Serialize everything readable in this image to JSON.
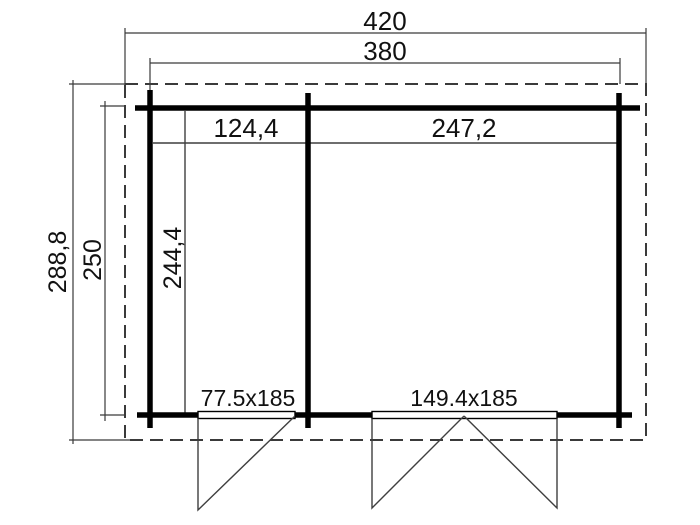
{
  "drawing": {
    "type": "floor-plan",
    "rooms": 2,
    "labels": {
      "overall_width": "420",
      "wall_outer_width": "380",
      "overall_depth": "288,8",
      "wall_outer_depth": "250",
      "left_room_width": "124,4",
      "right_room_width": "247,2",
      "interior_depth": "244,4",
      "single_door_size": "77.5x185",
      "double_door_size": "149.4x185"
    }
  },
  "colors": {
    "background": "#ffffff",
    "wall": "#000000",
    "thin_line": "#3f3f3f",
    "dimension_line": "#3a3a3a",
    "roof_outline": "#3a3a3a",
    "text": "#111111"
  }
}
